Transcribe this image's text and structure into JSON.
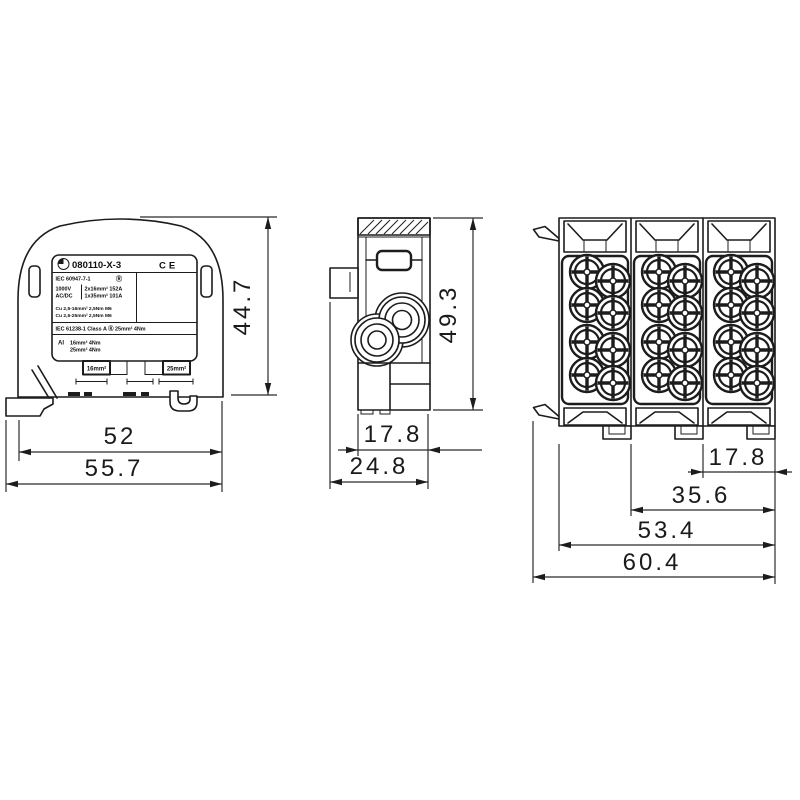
{
  "doc": {
    "type": "technical dimensional drawing",
    "subject": "DIN-rail power distribution terminal block, three views",
    "background": "#ffffff",
    "line_color": "#1c1c1c"
  },
  "front": {
    "dims": {
      "height": "44.7",
      "rail_width": "52",
      "total_width": "55.7"
    },
    "label": {
      "part_number": "080110-X-3",
      "ce": "CE",
      "standard": "IEC 60947-7-1",
      "reg_mark": "Ⓡ",
      "voltage": "1000V",
      "acdc": "AC/DC",
      "rating_line1": "2x16mm²  152A",
      "rating_line2": "1x35mm²  101A",
      "cu_line1": "Cu 2,5-16mm²  2,5Nm  M6",
      "cu_line2": "Cu 2,5-25mm²  2,5Nm  M6",
      "class_line": "IEC 61238-1   Class A   Ⓡ   25mm²   4Nm",
      "al": "Al",
      "al_line1": "16mm²   4Nm",
      "al_line2": "25mm²   4Nm",
      "tag_left": "16mm²",
      "tag_right": "25mm²"
    }
  },
  "side": {
    "dims": {
      "height": "49.3",
      "body_depth": "17.8",
      "total_depth": "24.8"
    }
  },
  "top": {
    "dims": {
      "module_pitch": "17.8",
      "span_two": "35.6",
      "span_three": "53.4",
      "total_width": "60.4"
    }
  }
}
